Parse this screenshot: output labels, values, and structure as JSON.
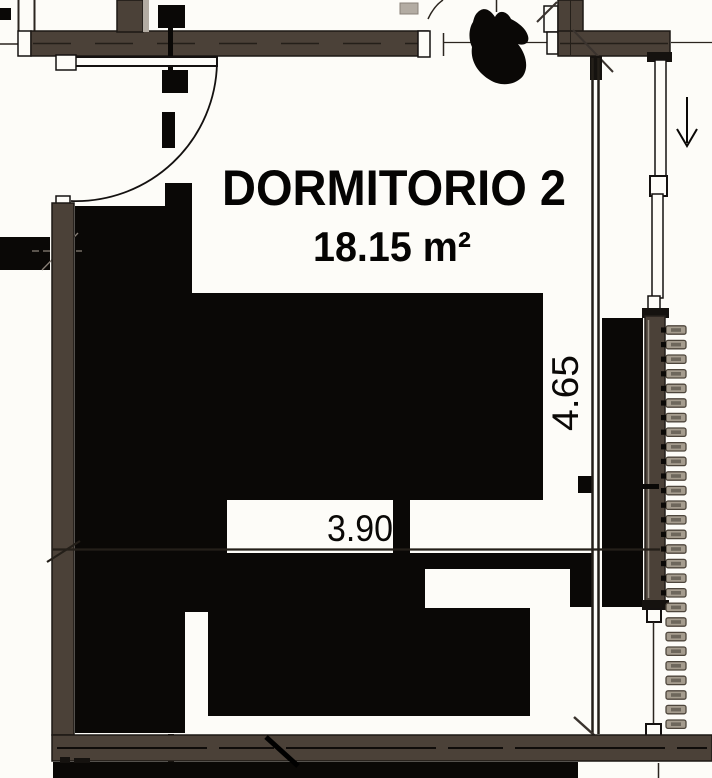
{
  "room": {
    "name": "DORMITORIO 2",
    "area": "18.15 m²"
  },
  "dimensions": {
    "width": "3.90",
    "height": "4.65"
  },
  "colors": {
    "wall_brown": "#4b4138",
    "fill_black": "#0a0806",
    "light_trim": "#b3aca3",
    "radiator_fin": "#a59c8e",
    "radiator_fin_inner": "#6e675c",
    "background": "#fdfcf8"
  }
}
